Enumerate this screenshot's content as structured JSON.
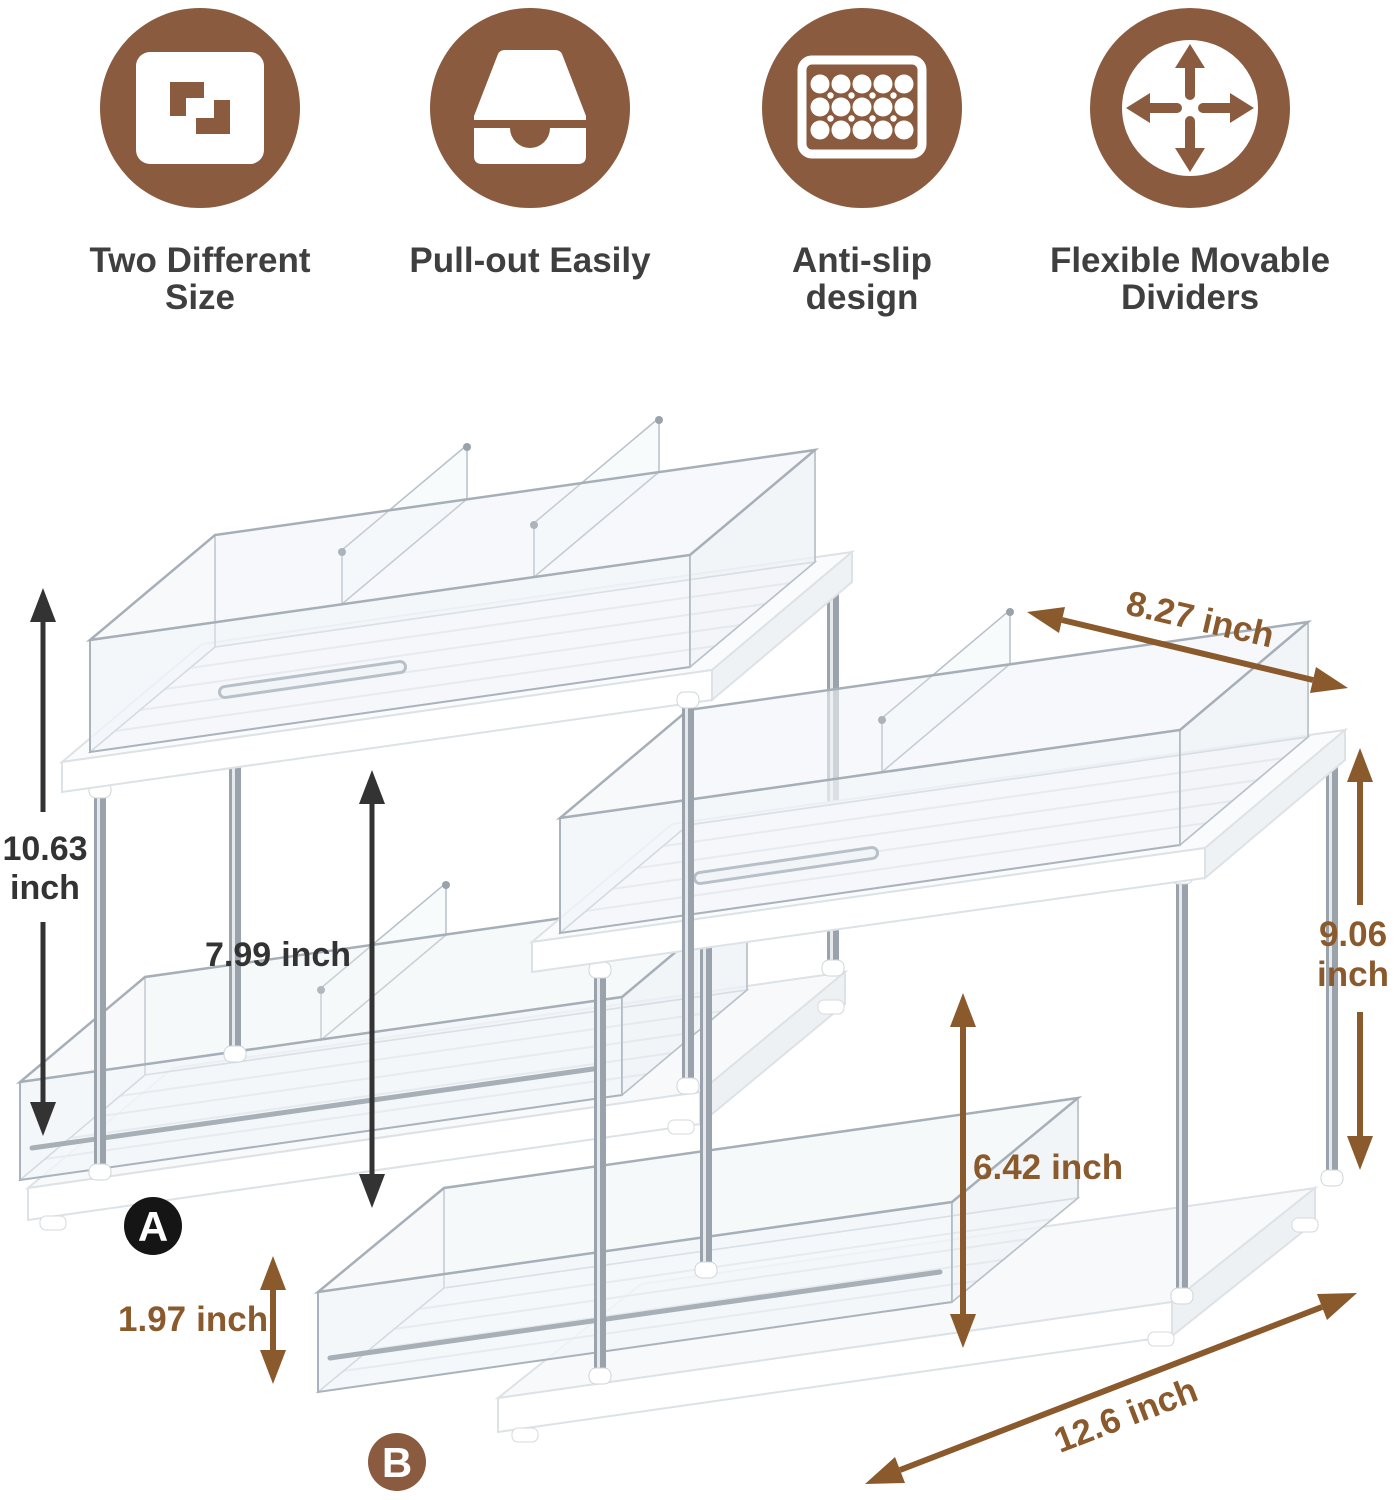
{
  "features": [
    {
      "name": "two-different-size",
      "line1": "Two Different",
      "line2": "Size"
    },
    {
      "name": "pull-out-easily",
      "line1": "Pull-out Easily",
      "line2": ""
    },
    {
      "name": "anti-slip-design",
      "line1": "Anti-slip design",
      "line2": ""
    },
    {
      "name": "flexible-movable-dividers",
      "line1": "Flexible Movable",
      "line2": "Dividers"
    }
  ],
  "units": [
    {
      "label": "A"
    },
    {
      "label": "B"
    }
  ],
  "dimensions": {
    "total_height_a": {
      "value": "10.63",
      "unit": "inch"
    },
    "tier_clearance_a": {
      "value": "7.99",
      "unit": "inch"
    },
    "depth_b": {
      "value": "8.27",
      "unit": "inch"
    },
    "total_height_b": {
      "value": "9.06",
      "unit": "inch"
    },
    "tier_clearance_b": {
      "value": "6.42",
      "unit": "inch"
    },
    "tray_height": {
      "value": "1.97",
      "unit": "inch"
    },
    "length_b": {
      "value": "12.6",
      "unit": "inch"
    }
  },
  "colors": {
    "icon_brown": "#8a5b3f",
    "dimension_brown": "#8a5a2d",
    "annotation_dark": "#333333",
    "label_dark": "#3f3f3f",
    "badge_black": "#151515"
  }
}
